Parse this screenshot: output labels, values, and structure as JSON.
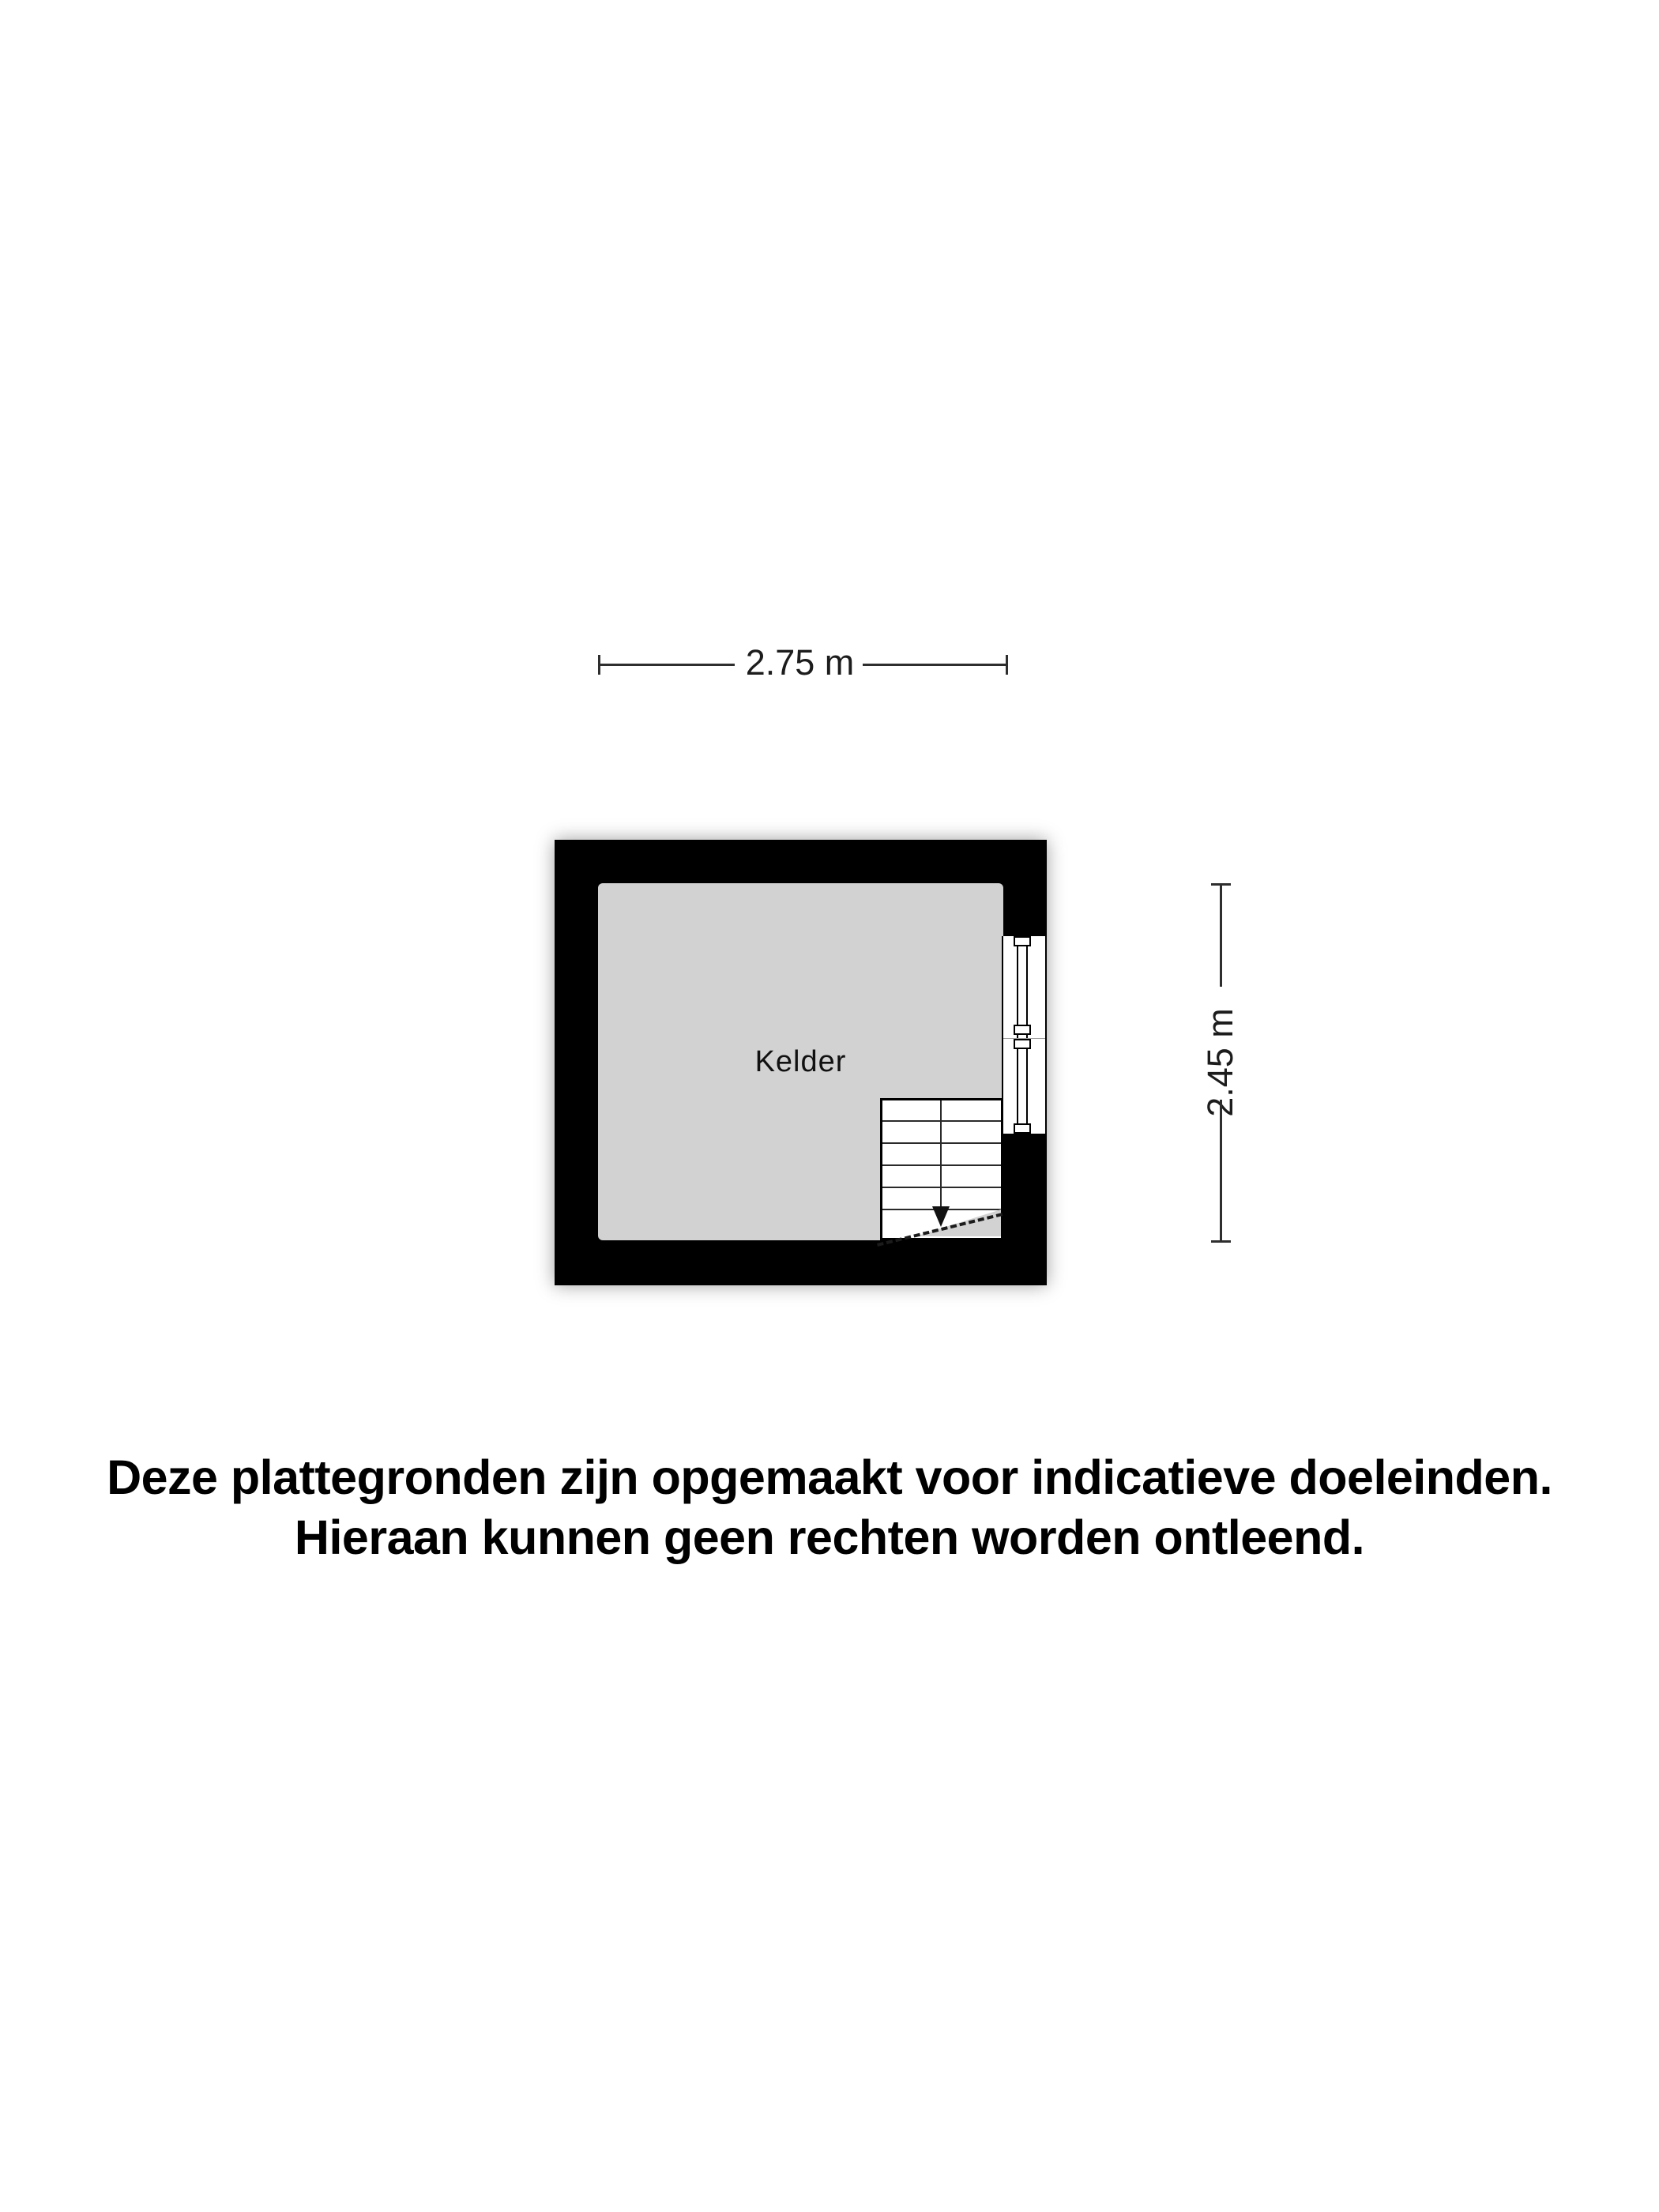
{
  "colors": {
    "page": "#ffffff",
    "wall": "#000000",
    "floor": "#d2d2d2",
    "line": "#2e2e2e",
    "text": "#000000"
  },
  "dimensions": {
    "width_label": "2.75 m",
    "height_label": "2.45 m"
  },
  "room": {
    "label": "Kelder"
  },
  "stairs": {
    "tread_count": 6,
    "direction": "down"
  },
  "disclaimer": {
    "line1": "Deze plattegronden zijn opgemaakt voor indicatieve doeleinden.",
    "line2": "Hieraan kunnen geen rechten worden ontleend."
  }
}
